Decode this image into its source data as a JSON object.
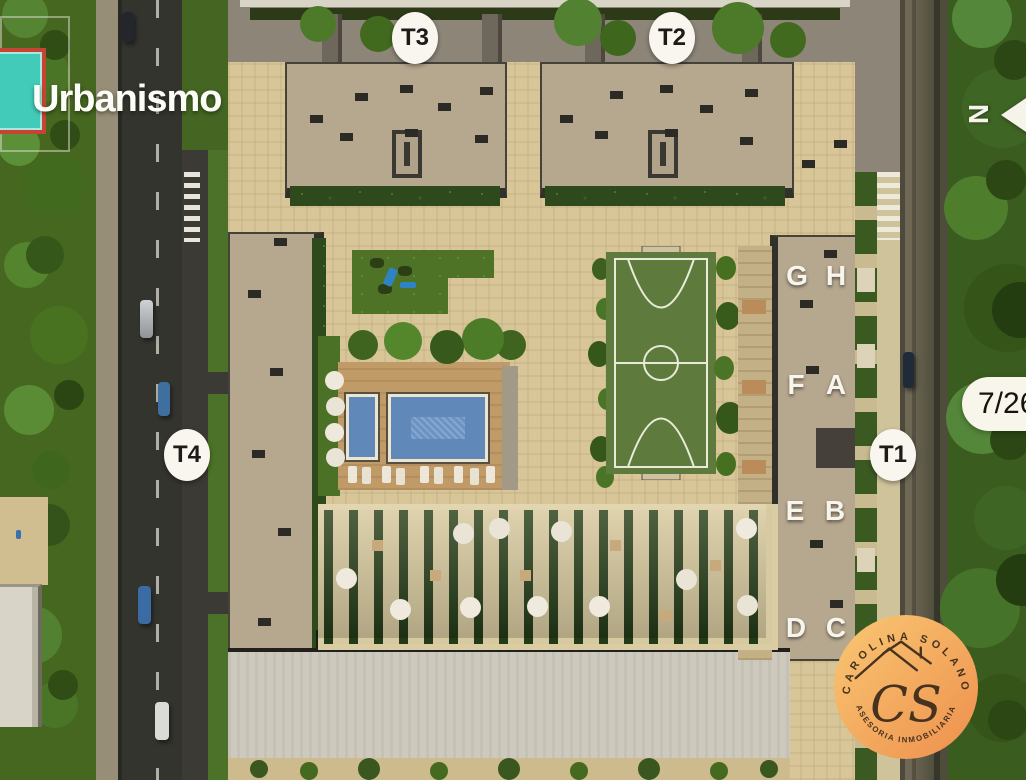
{
  "view": {
    "title": "Urbanismo",
    "page_indicator": "7/26",
    "compass_label": "N"
  },
  "towers": {
    "t3": "T3",
    "t2": "T2",
    "t4": "T4",
    "t1": "T1"
  },
  "units": {
    "g": "G",
    "h": "H",
    "f": "F",
    "a": "A",
    "e": "E",
    "b": "B",
    "d": "D",
    "c": "C"
  },
  "logo": {
    "name_arc": "CAROLINA SOLANO",
    "tagline_arc": "ASESORIA INMOBILIARIA",
    "initials": "CS"
  },
  "colors": {
    "badge_bg": "#f8f6ee",
    "badge_text": "#1c1b17",
    "unit_letter": "#f7f5ec",
    "logo_gradient_start": "#f9c873",
    "logo_gradient_end": "#ee8f4d",
    "logo_text": "#46321f",
    "pool_water": "#6b93c3",
    "field_green": "#5e7a3c",
    "court_teal": "#41cbb8",
    "courtyard": "#d8c698"
  }
}
